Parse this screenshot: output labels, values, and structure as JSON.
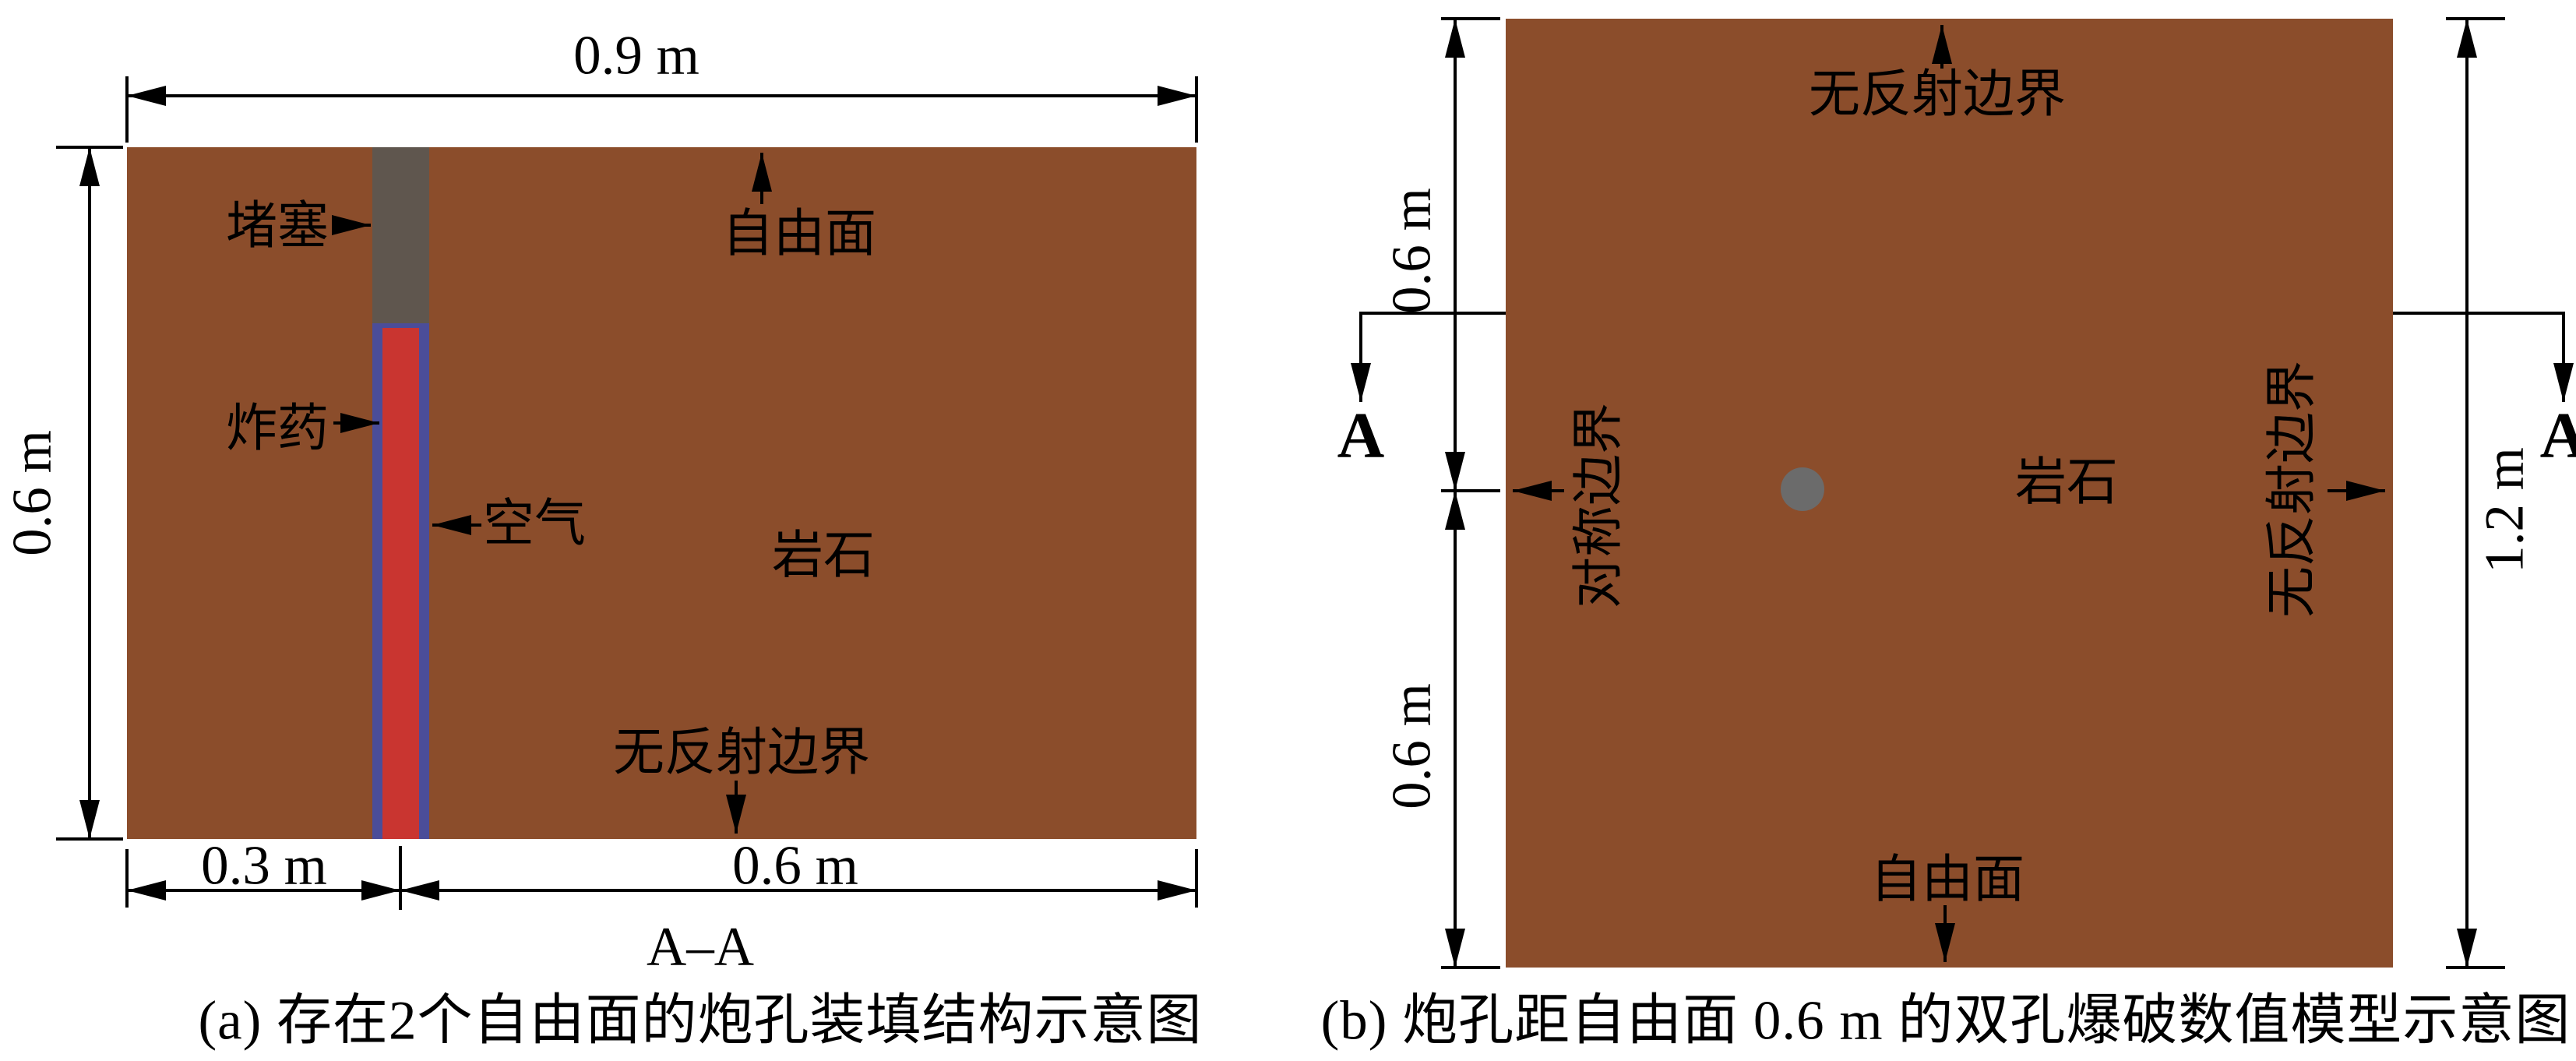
{
  "figure": {
    "panel_a": {
      "caption": "(a) 存在2个自由面的炮孔装填结构示意图",
      "section_label": "A–A",
      "dim_top": "0.9 m",
      "dim_left": "0.6 m",
      "dim_bottom_left": "0.3 m",
      "dim_bottom_right": "0.6 m",
      "labels": {
        "stemming": "堵塞",
        "explosive": "炸药",
        "air": "空气",
        "free_surface": "自由面",
        "rock": "岩石",
        "non_reflecting_boundary": "无反射边界"
      },
      "colors": {
        "rock": "#8b4d2b",
        "stemming": "#5f564e",
        "explosive": "#c93530",
        "air": "#4b4d99"
      }
    },
    "panel_b": {
      "caption": "(b) 炮孔距自由面 0.6 m 的双孔爆破数值模型示意图",
      "section_marker_left": "A",
      "section_marker_right": "A",
      "dim_left_upper": "0.6 m",
      "dim_left_lower": "0.6 m",
      "dim_right": "1.2 m",
      "labels": {
        "non_reflecting_boundary_top": "无反射边界",
        "symmetry_boundary": "对称边界",
        "rock": "岩石",
        "non_reflecting_boundary_right": "无反射边界",
        "free_surface": "自由面"
      },
      "colors": {
        "rock": "#8b4d2b",
        "blast_hole": "#6b6b6b"
      }
    }
  }
}
